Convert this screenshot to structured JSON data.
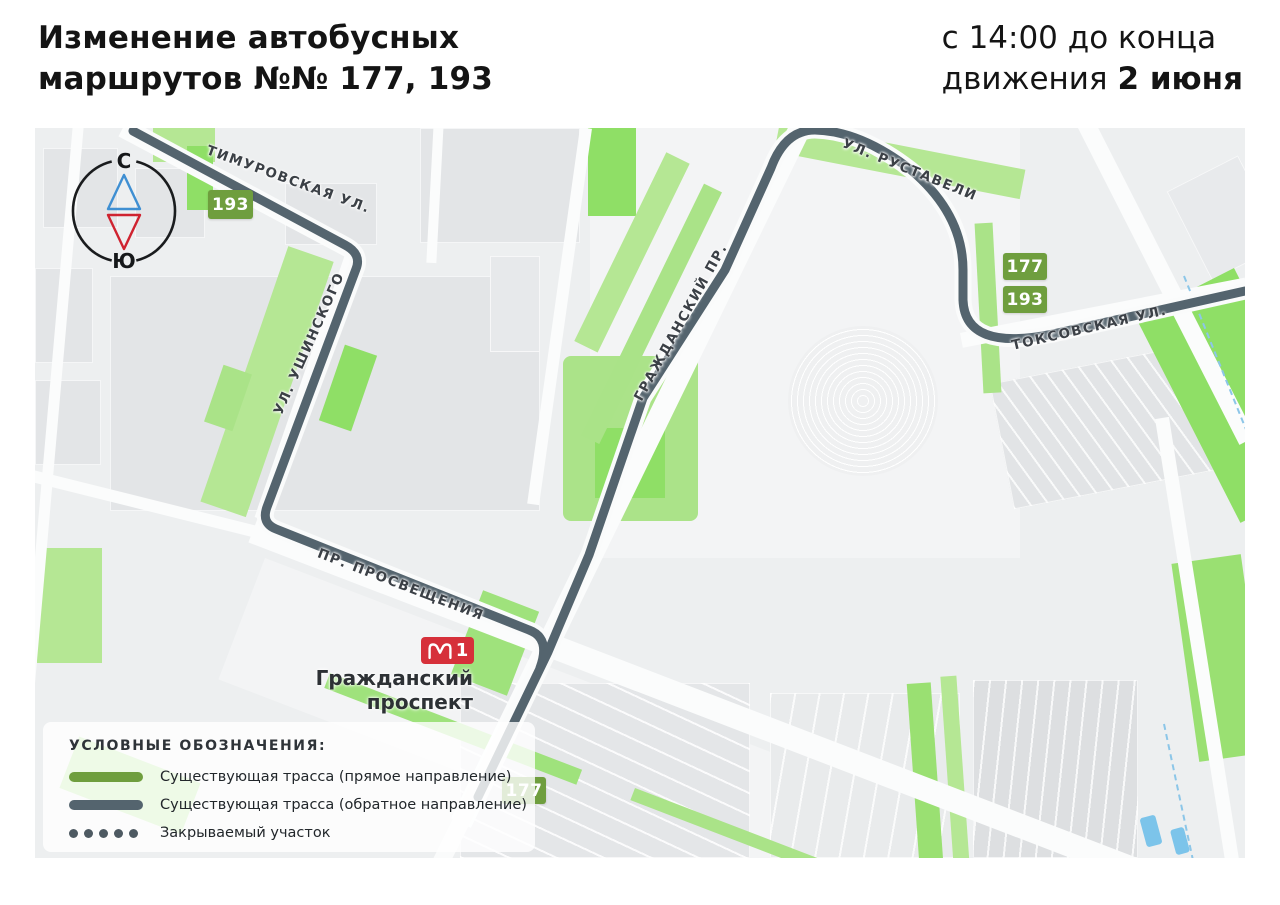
{
  "header": {
    "title_line1": "Изменение автобусных",
    "title_line2": "маршрутов №№ 177, 193",
    "time_line1": "с 14:00 до конца",
    "time_line2_prefix": "движения ",
    "time_line2_bold": "2 июня"
  },
  "compass": {
    "north_label": "С",
    "south_label": "Ю"
  },
  "streets": {
    "timurovskaya": "ТИМУРОВСКАЯ УЛ.",
    "ushinskogo": "УЛ. УШИНСКОГО",
    "grazhdansky": "ГРАЖДАНСКИЙ ПР.",
    "rustaveli": "УЛ. РУСТАВЕЛИ",
    "toksovskaya": "ТОКСОВСКАЯ УЛ.",
    "prosveshcheniya": "ПР. ПРОСВЕЩЕНИЯ"
  },
  "badges": {
    "timurovskaya_193": "193",
    "right_177": "177",
    "right_193": "193",
    "bottom_177": "177"
  },
  "metro": {
    "line_number": "1",
    "station_name_line1": "Гражданский",
    "station_name_line2": "проспект"
  },
  "legend": {
    "title": "УСЛОВНЫЕ ОБОЗНАЧЕНИЯ:",
    "items": [
      {
        "label": "Существующая трасса (прямое направление)",
        "type": "line",
        "color": "#6f9e3e"
      },
      {
        "label": "Существующая трасса (обратное направление)",
        "type": "line",
        "color": "#54646e"
      },
      {
        "label": "Закрываемый участок",
        "type": "dots",
        "color": "#4e5a62"
      }
    ]
  },
  "colors": {
    "route_reverse": "#54646e",
    "route_forward": "#6f9e3e",
    "badge_green": "#6f9e3e",
    "metro_red": "#d6303a",
    "compass_north_triangle": "#3f8fd2",
    "compass_south_triangle": "#cf2330",
    "map_background": "#edeff0"
  }
}
